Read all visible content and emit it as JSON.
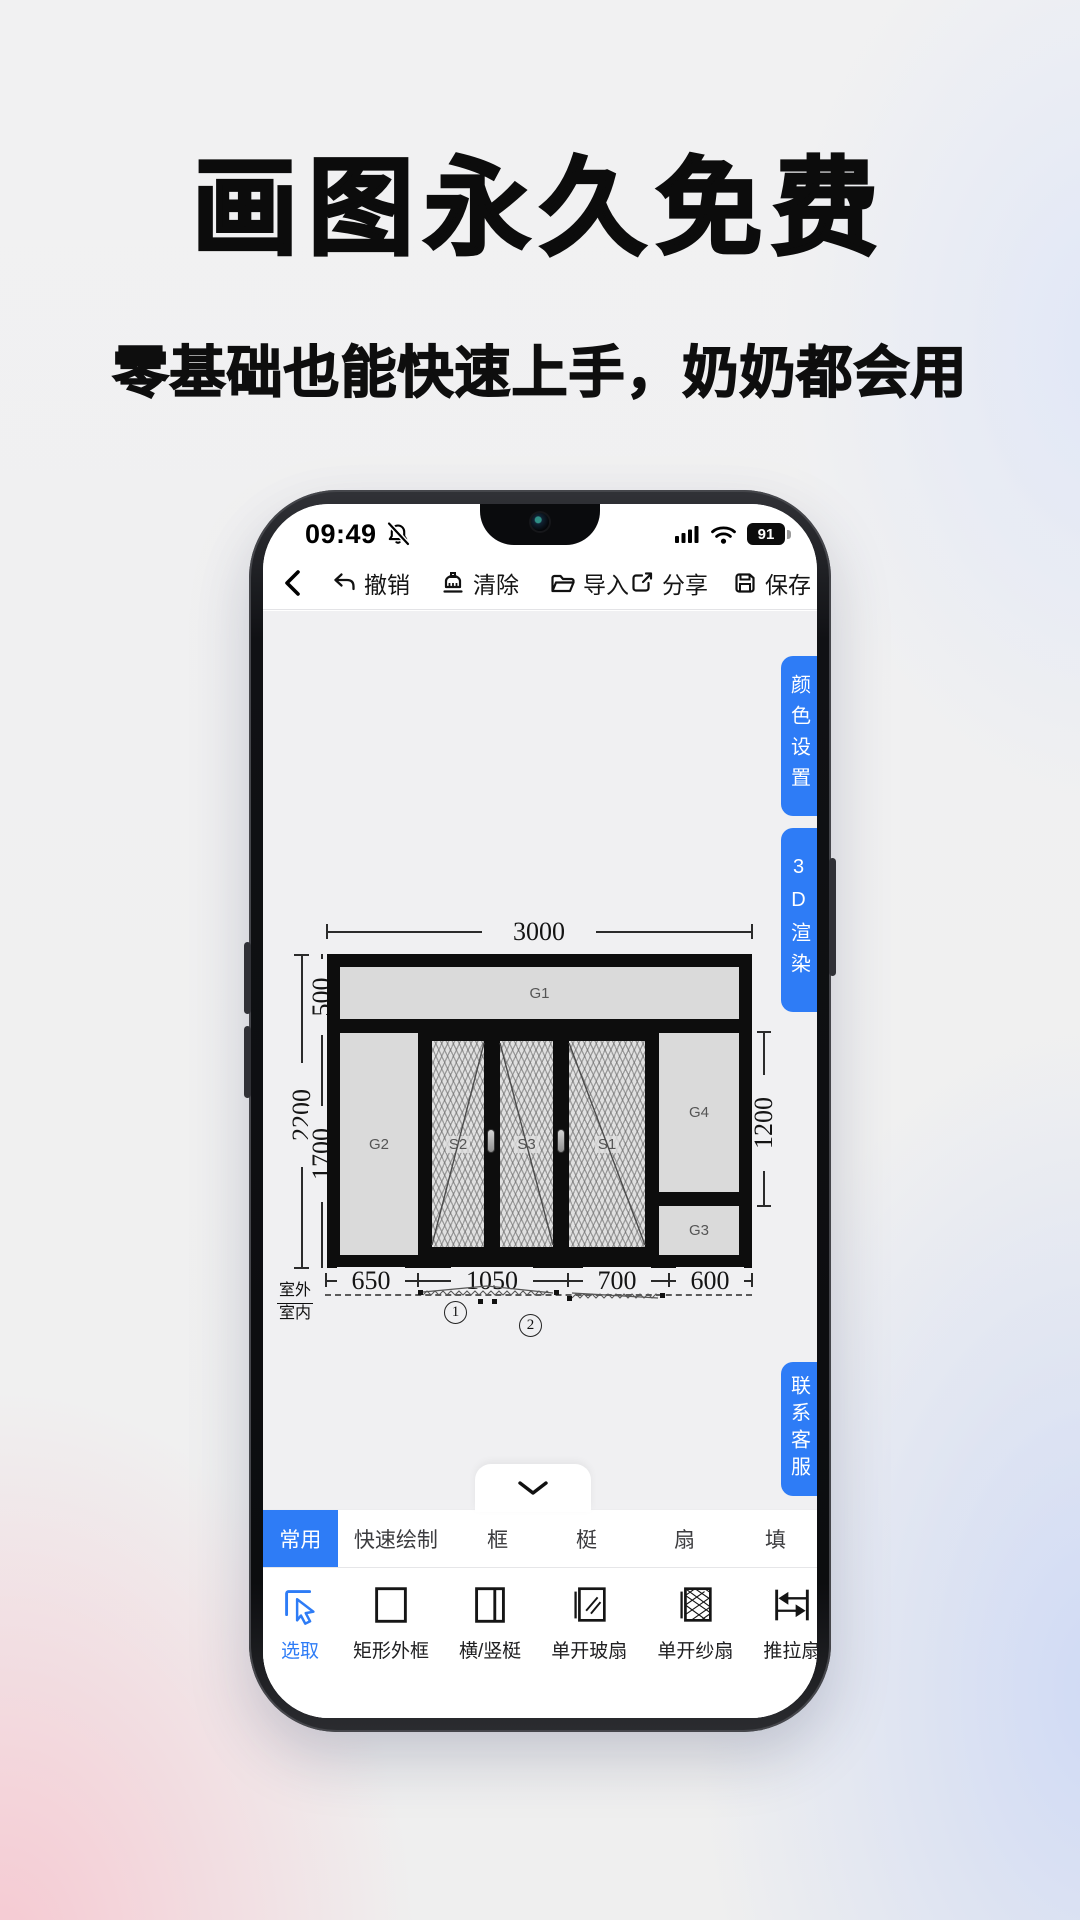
{
  "colors": {
    "accent": "#2e7cf6",
    "canvas_bg": "#f0f0f2",
    "panel_gray": "#dadada"
  },
  "hero": {
    "title": "画图永久免费",
    "subtitle": "零基础也能快速上手，奶奶都会用"
  },
  "phone": {
    "statusbar": {
      "time": "09:49",
      "battery": "91"
    },
    "toolbar": {
      "undo": "撤销",
      "clear": "清除",
      "import": "导入",
      "share": "分享",
      "save": "保存"
    },
    "side_buttons": {
      "color_settings": "颜色设置",
      "render_3d": "3D渲染",
      "contact_support": "联系客服"
    },
    "tabs": [
      {
        "label": "常用"
      },
      {
        "label": "快速绘制"
      },
      {
        "label": "框"
      },
      {
        "label": "梃"
      },
      {
        "label": "扇"
      },
      {
        "label": "填"
      }
    ],
    "tools": [
      {
        "label": "选取"
      },
      {
        "label": "矩形外框"
      },
      {
        "label": "横/竖梃"
      },
      {
        "label": "单开玻扇"
      },
      {
        "label": "单开纱扇"
      },
      {
        "label": "推拉扇"
      },
      {
        "label": "单"
      }
    ]
  },
  "drawing": {
    "dims": {
      "total_width": "3000",
      "total_height": "2200",
      "top_height": "500",
      "lower_height": "1700",
      "right_height": "1200",
      "bottom": [
        "650",
        "1050",
        "700",
        "600"
      ]
    },
    "panels": {
      "g1": "G1",
      "g2": "G2",
      "s2": "S2",
      "s3": "S3",
      "s1": "S1",
      "g4": "G4",
      "g3": "G3"
    },
    "context": {
      "outside": "室外",
      "inside": "室内"
    },
    "markers": [
      {
        "n": "1"
      },
      {
        "n": "2"
      }
    ]
  }
}
